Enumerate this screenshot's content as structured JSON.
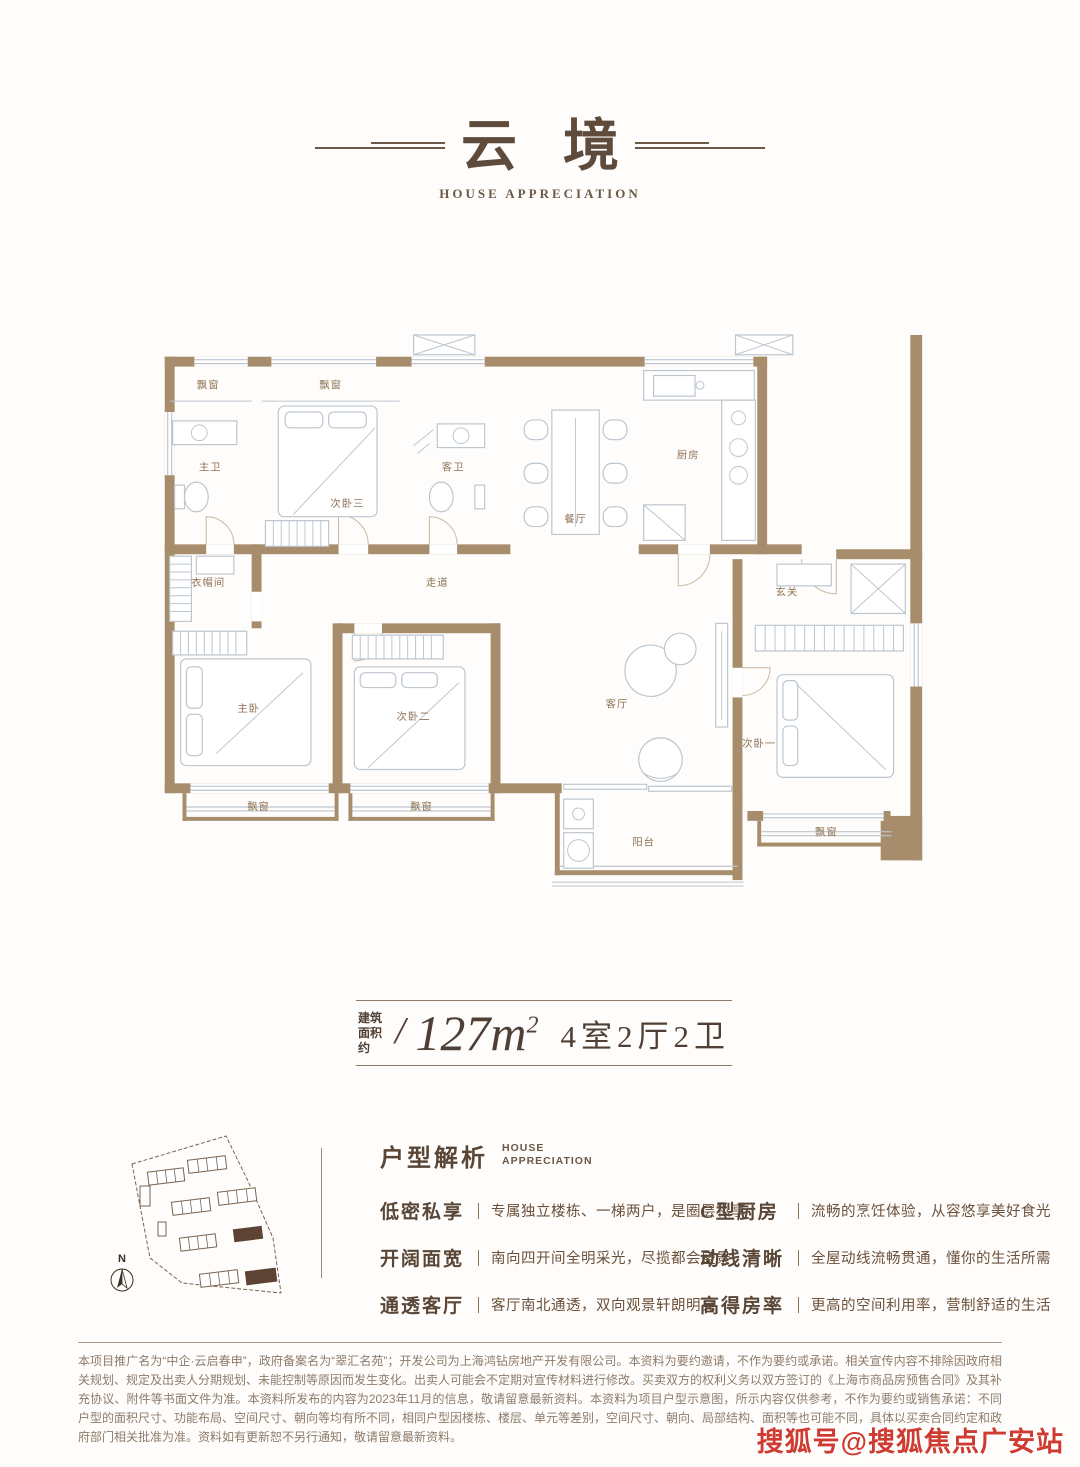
{
  "colors": {
    "wall": "#a78d6c",
    "furn": "#bcc6cf",
    "label": "#8f7355",
    "dark": "#5a4636",
    "body": "#6b503a",
    "muted": "#8d7b6b",
    "red": "#cf3b30",
    "site": "#7a6450",
    "site_fill": "#5d4334"
  },
  "header": {
    "title_char1": "云",
    "title_char2": "境",
    "subtitle": "HOUSE APPRECIATION"
  },
  "floorplan": {
    "rooms": [
      {
        "label": "飘窗",
        "x": 64,
        "y": 62
      },
      {
        "label": "飘窗",
        "x": 188,
        "y": 62
      },
      {
        "label": "主卫",
        "x": 66,
        "y": 145
      },
      {
        "label": "次卧三",
        "x": 205,
        "y": 182
      },
      {
        "label": "客卫",
        "x": 312,
        "y": 145
      },
      {
        "label": "餐厅",
        "x": 436,
        "y": 198
      },
      {
        "label": "厨房",
        "x": 550,
        "y": 133
      },
      {
        "label": "衣帽间",
        "x": 64,
        "y": 262
      },
      {
        "label": "走道",
        "x": 296,
        "y": 262
      },
      {
        "label": "玄关",
        "x": 650,
        "y": 272
      },
      {
        "label": "主卧",
        "x": 105,
        "y": 390
      },
      {
        "label": "次卧二",
        "x": 272,
        "y": 398
      },
      {
        "label": "客厅",
        "x": 478,
        "y": 385
      },
      {
        "label": "次卧一",
        "x": 622,
        "y": 425
      },
      {
        "label": "阳台",
        "x": 505,
        "y": 525
      },
      {
        "label": "飘窗",
        "x": 115,
        "y": 489
      },
      {
        "label": "飘窗",
        "x": 280,
        "y": 489
      },
      {
        "label": "飘窗",
        "x": 690,
        "y": 515
      }
    ]
  },
  "spec": {
    "prefix_line1": "建筑",
    "prefix_line2": "面积约",
    "slash": "/",
    "area_value": "127m",
    "area_sup": "2",
    "layout": "4室2厅2卫"
  },
  "analysis": {
    "title": "户型解析",
    "subtitle_line1": "HOUSE",
    "subtitle_line2": "APPRECIATION",
    "compass_label": "N",
    "features_left": [
      {
        "label": "低密私享",
        "desc": "专属独立楼栋、一梯两户，是圈层私享"
      },
      {
        "label": "开阔面宽",
        "desc": "南向四开间全明采光，尽揽都会盛景"
      },
      {
        "label": "通透客厅",
        "desc": "客厅南北通透，双向观景轩朗明亮"
      }
    ],
    "features_right": [
      {
        "label": "C型厨房",
        "desc": "流畅的烹饪体验，从容悠享美好食光"
      },
      {
        "label": "动线清晰",
        "desc": "全屋动线流畅贯通，懂你的生活所需"
      },
      {
        "label": "高得房率",
        "desc": "更高的空间利用率，营制舒适的生活"
      }
    ]
  },
  "disclaimer": {
    "text": "本项目推广名为“中企·云启春申”，政府备案名为“翠汇名苑”；开发公司为上海鸿钻房地产开发有限公司。本资料为要约邀请，不作为要约或承诺。相关宣传内容不排除因政府相关规划、规定及出卖人分期规划、未能控制等原因而发生变化。出卖人可能会不定期对宣传材料进行修改。买卖双方的权利义务以双方签订的《上海市商品房预售合同》及其补充协议、附件等书面文件为准。本资料所发布的内容为2023年11月的信息，敬请留意最新资料。本资料为项目户型示意图，所示内容仅供参考，不作为要约或销售承诺：不同户型的面积尺寸、功能布局、空间尺寸、朝向等均有所不同，相同户型因楼栋、楼层、单元等差别，空间尺寸、朝向、局部结构、面积等也可能不同，具体以买卖合同约定和政府部门相关批准为准。资料如有更新恕不另行通知，敬请留意最新资料。"
  },
  "watermark": {
    "text": "搜狐号@搜狐焦点广安站"
  }
}
